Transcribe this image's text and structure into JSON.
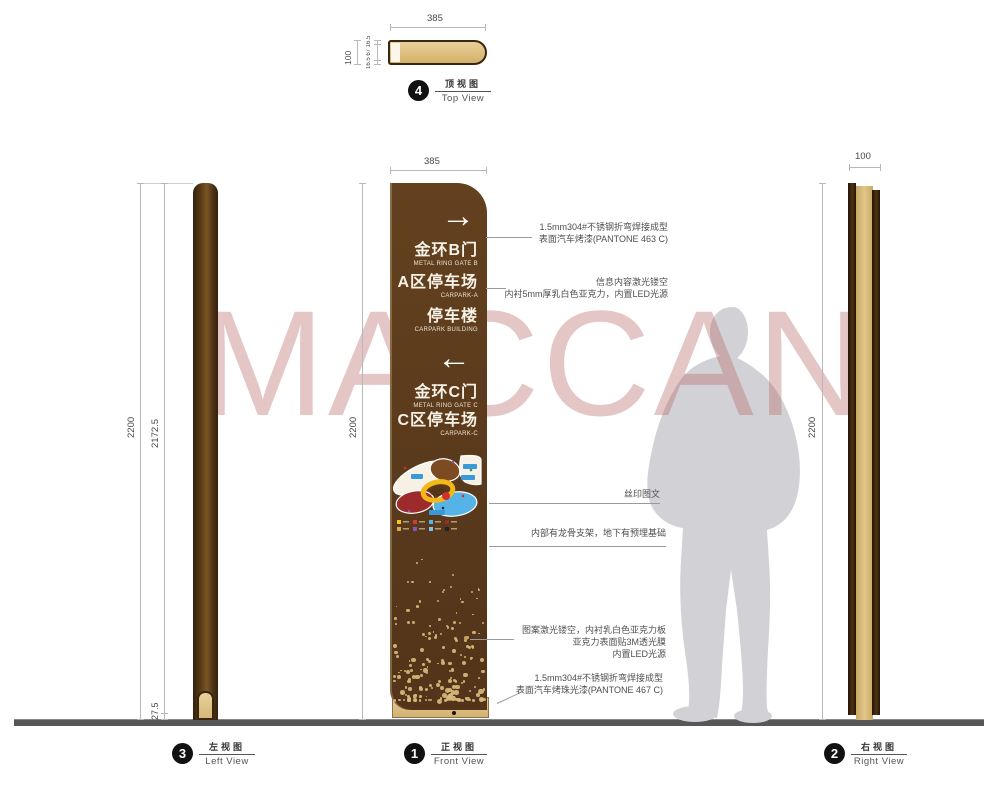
{
  "watermark_text": "MACCAN",
  "colors": {
    "sign_brown": "#5a3a1c",
    "panel_tan": "#d9bc7f",
    "watermark_pink": "#d7a3a3",
    "silhouette_gray": "#d2d2d6",
    "ground_gray": "#57575a"
  },
  "top_view": {
    "number": "4",
    "label_zh": "顶视图",
    "label_en": "Top View",
    "dim_width": "385",
    "dim_depth": "100",
    "dim_sections": "16.5 67 16.5"
  },
  "front_view": {
    "number": "1",
    "label_zh": "正视图",
    "label_en": "Front View",
    "dim_width": "385",
    "dim_height": "2200"
  },
  "left_view": {
    "number": "3",
    "label_zh": "左视图",
    "label_en": "Left View",
    "dim_height": "2200",
    "dim_body": "2172.5",
    "dim_base": "27.5"
  },
  "right_view": {
    "number": "2",
    "label_zh": "右视图",
    "label_en": "Right View",
    "dim_width": "100",
    "dim_height": "2200"
  },
  "sign": {
    "arrow_right": "→",
    "arrow_left": "←",
    "entries": [
      {
        "zh": "金环B门",
        "en": "METAL RING GATE B"
      },
      {
        "zh": "A区停车场",
        "en": "CARPARK-A"
      },
      {
        "zh": "停车楼",
        "en": "CARPARK BUILDING"
      },
      {
        "zh": "金环C门",
        "en": "METAL RING GATE C"
      },
      {
        "zh": "C区停车场",
        "en": "CARPARK-C"
      }
    ]
  },
  "annotations": [
    {
      "lines": [
        "1.5mm304#不锈钢折弯焊接成型",
        "表面汽车烤漆(PANTONE 463 C)"
      ]
    },
    {
      "lines": [
        "信息内容激光镂空",
        "内衬5mm厚乳白色亚克力，内置LED光源"
      ]
    },
    {
      "lines": [
        "丝印图文"
      ]
    },
    {
      "lines": [
        "内部有龙骨支架，地下有预埋基础"
      ]
    },
    {
      "lines": [
        "图案激光镂空，内衬乳白色亚克力板",
        "亚克力表面贴3M透光膜",
        "内置LED光源"
      ]
    },
    {
      "lines": [
        "1.5mm304#不锈钢折弯焊接成型",
        "表面汽车烤珠光漆(PANTONE 467 C)"
      ]
    }
  ]
}
